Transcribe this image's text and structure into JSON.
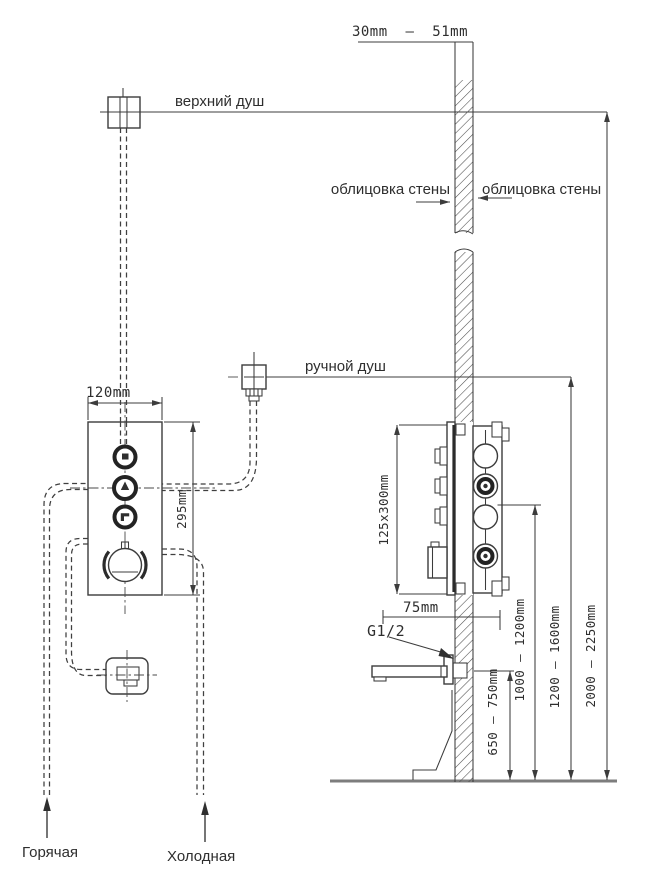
{
  "drawing": {
    "annotations": {
      "upper_shower": "верхний душ",
      "hand_shower": "ручной душ",
      "wall_cladding_left": "облицовка стены",
      "wall_cladding_right": "облицовка стены",
      "thread_size": "G1/2",
      "hot_supply": "Горячая",
      "cold_supply": "Холодная"
    },
    "dimensions": {
      "finish_thickness": "30mm  –  51mm",
      "panel_width": "120mm",
      "panel_height": "295mm",
      "valve_box_size": "125x300mm",
      "valve_offset": "75mm",
      "spout_height": "650 – 750mm",
      "valve_center_height": "1000 – 1200mm",
      "hand_shower_height": "1200 – 1600mm",
      "upper_shower_height": "2000 – 2250mm"
    },
    "colors": {
      "line": "#3c3c3c",
      "floor": "#7d7d7d",
      "background": "#ffffff"
    }
  }
}
